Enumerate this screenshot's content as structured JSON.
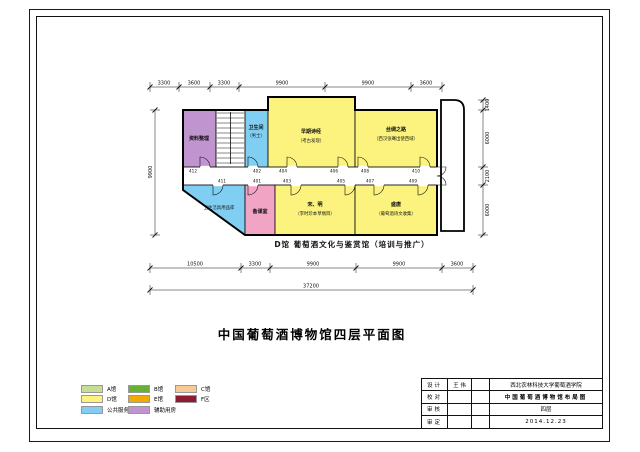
{
  "drawing": {
    "title": "中国葡萄酒博物馆四层平面图",
    "caption": "D馆  葡萄酒文化与鉴赏馆（培训与推广）"
  },
  "plan": {
    "rooms": {
      "archive": {
        "line1": "资料整理"
      },
      "wc": {
        "line1": "卫生间",
        "line2": "（男士）"
      },
      "early": {
        "line1": "早期诗经",
        "line2": "（考古发现）"
      },
      "silk": {
        "line1": "丝绸之路",
        "line2": "（西汉张骞出使西域）"
      },
      "cleanstore": {
        "line1": "卫生洁具用品库"
      },
      "prep": {
        "line1": "备课室"
      },
      "songming": {
        "line1": "宋、明",
        "line2": "（李时珍本草纲目）"
      },
      "tang": {
        "line1": "盛唐",
        "line2": "（葡萄酒诗文收集）"
      }
    },
    "room_numbers_top": [
      "412",
      "402",
      "404",
      "406",
      "408",
      "410"
    ],
    "room_numbers_bottom": [
      "411",
      "401",
      "403",
      "405",
      "407",
      "409"
    ],
    "dims_top": [
      "3300",
      "3600",
      "3300",
      "9900",
      "9900",
      "3600"
    ],
    "dims_bottom": [
      "10500",
      "3300",
      "9900",
      "9900",
      "3600"
    ],
    "dim_total": "37200",
    "dims_right": [
      "1400",
      "6000",
      "2100",
      "6000"
    ],
    "dim_left": "9900"
  },
  "legend": {
    "items": [
      {
        "label": "A馆",
        "color": "#c8de92"
      },
      {
        "label": "B馆",
        "color": "#67b135"
      },
      {
        "label": "C馆",
        "color": "#f7ca94"
      },
      {
        "label": "D馆",
        "color": "#fbf37d"
      },
      {
        "label": "E馆",
        "color": "#f1ab00"
      },
      {
        "label": "F区",
        "color": "#8e1c30"
      },
      {
        "label": "公共服务区",
        "color": "#80cff2"
      },
      {
        "label": "辅助用房",
        "color": "#c094ce"
      }
    ]
  },
  "titleblock": {
    "rows": [
      {
        "label": "设计",
        "value": "王 伟"
      },
      {
        "label": "校对",
        "value": ""
      },
      {
        "label": "审核",
        "value": ""
      },
      {
        "label": "审定",
        "value": ""
      }
    ],
    "institute": "西北农林科技大学葡萄酒学院",
    "project": "中国葡萄酒博物馆布局图",
    "sheet": "四层",
    "date": "2014.12.23"
  },
  "colors": {
    "hall_d_room": "#fbf37d",
    "public_room": "#80cff2",
    "aux_room": "#c094ce",
    "prep_room": "#f2a4c4"
  }
}
